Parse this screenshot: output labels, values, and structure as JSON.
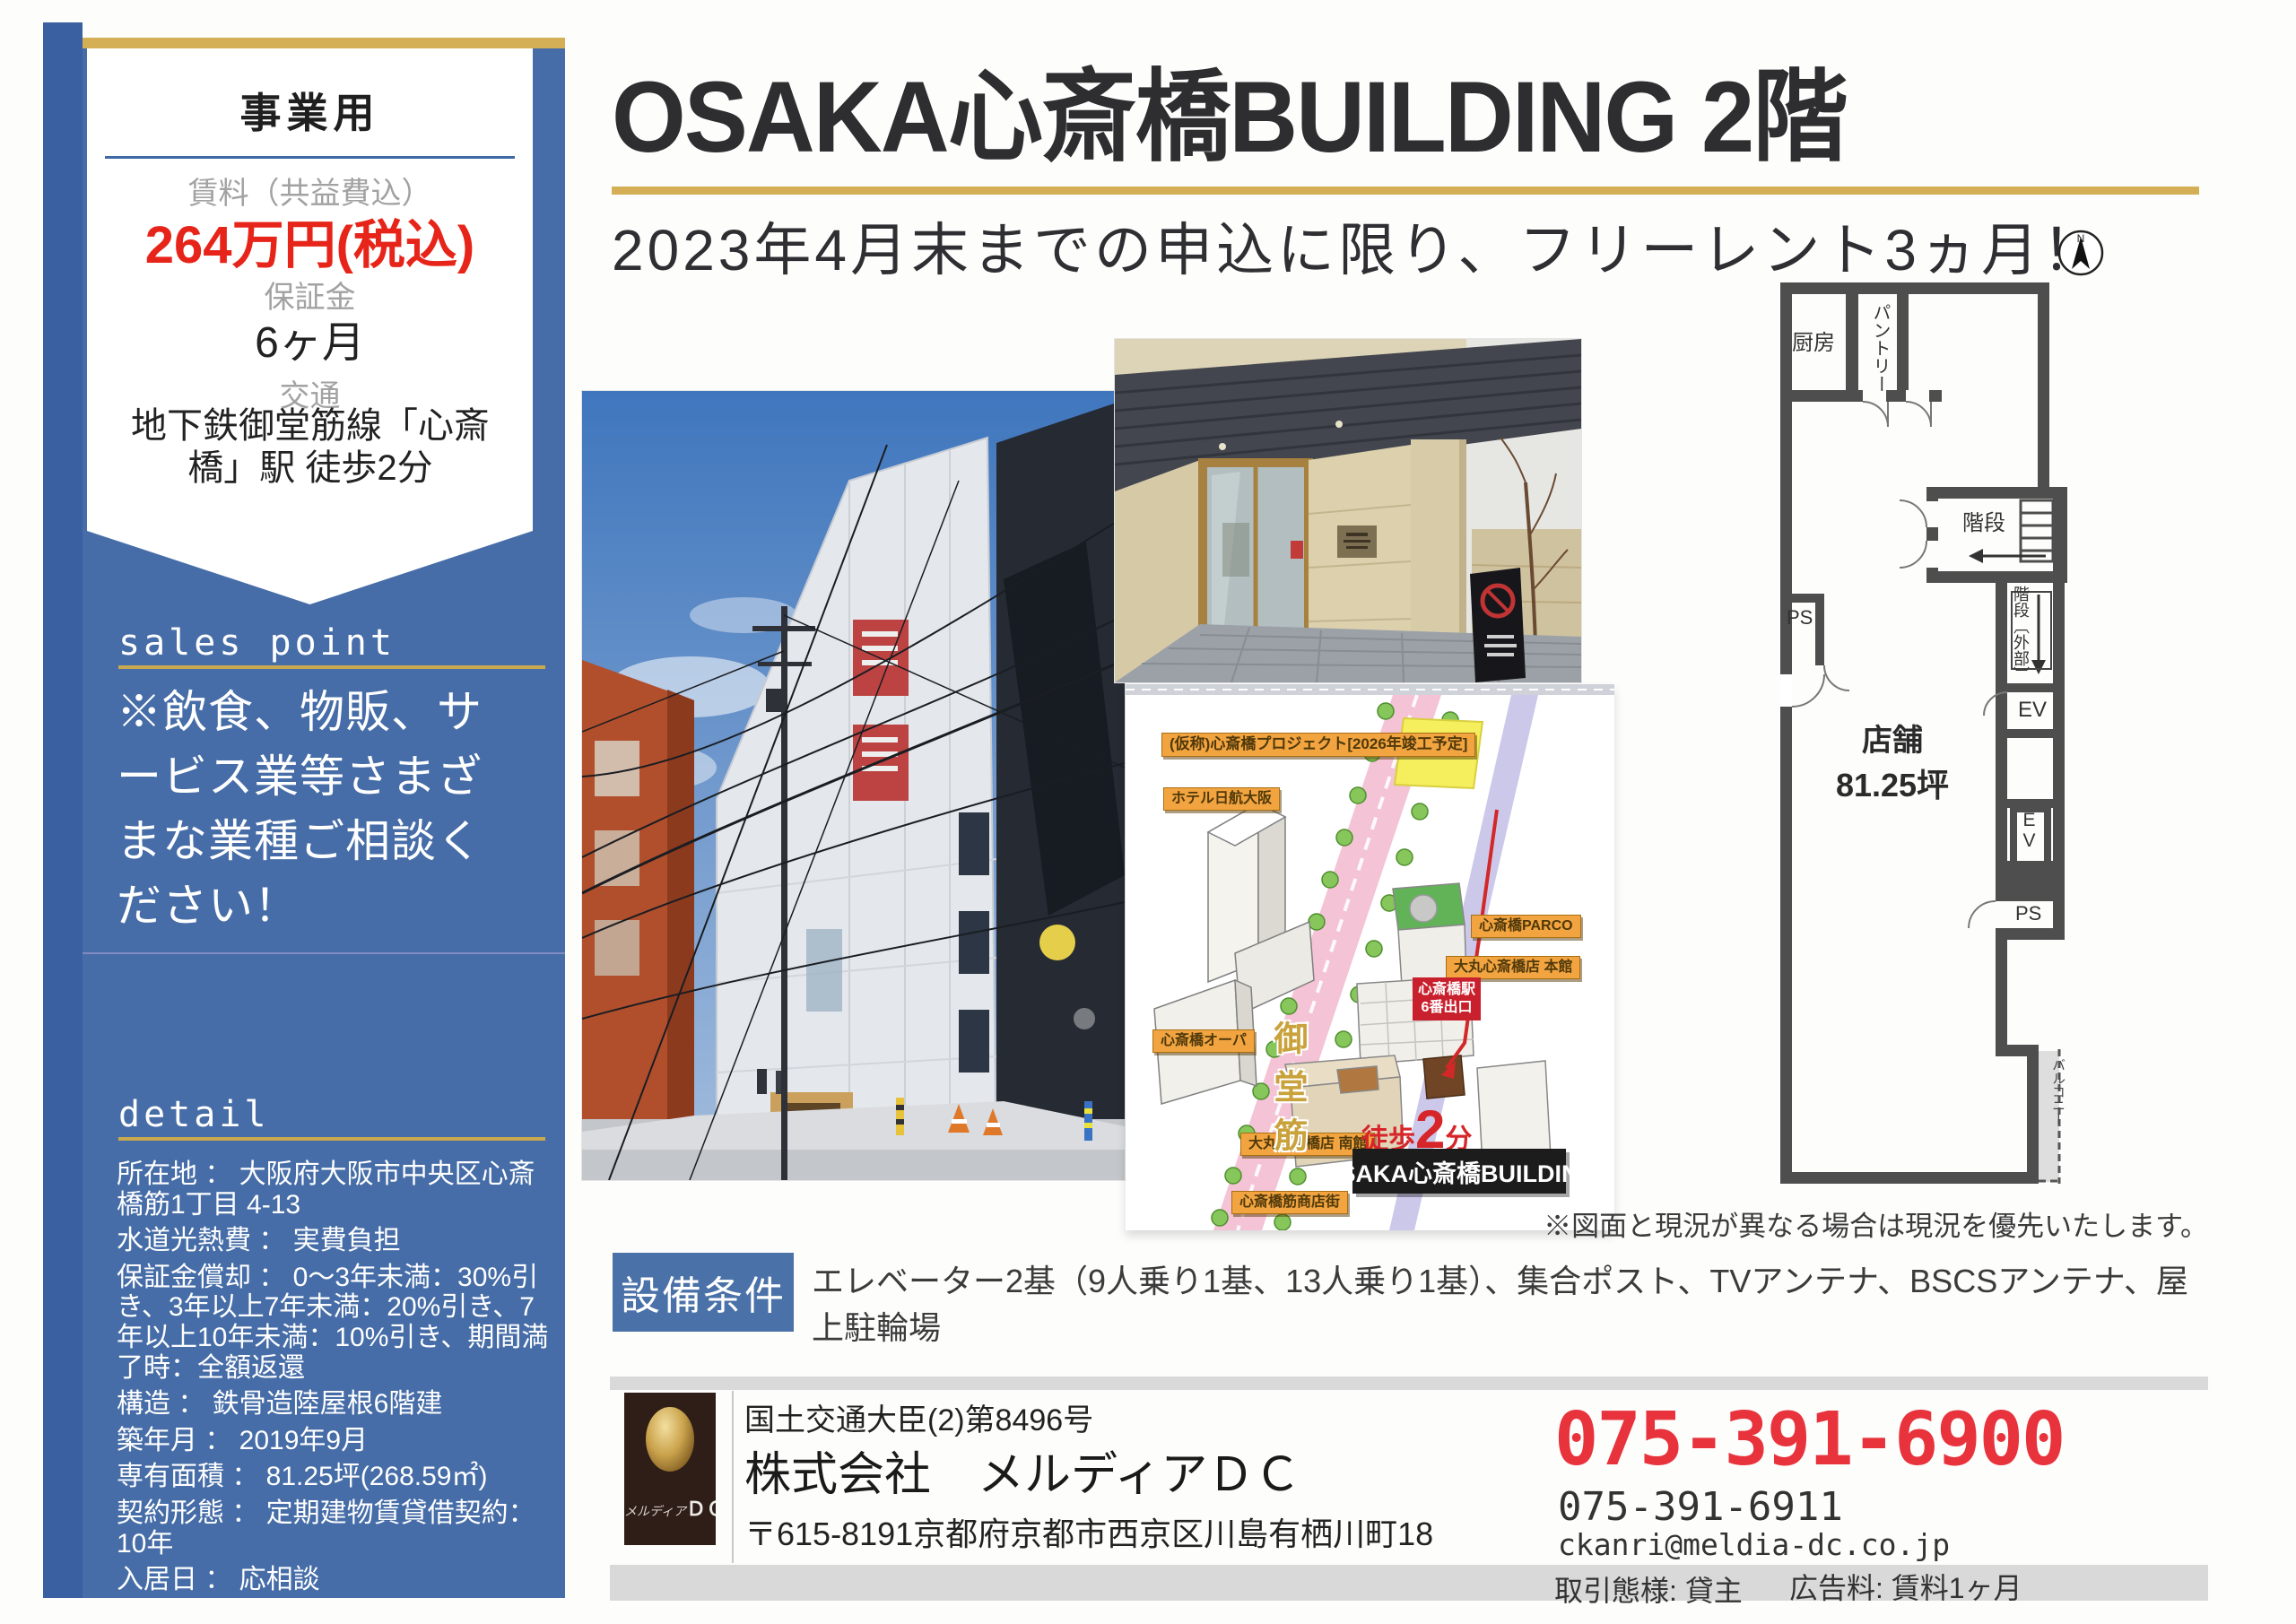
{
  "colors": {
    "accent_gold": "#d4af56",
    "sidebar_blue": "#466da7",
    "price_red": "#e72419",
    "phone_red": "#e8323c",
    "equipment_blue": "#4a72a8",
    "wall_gray": "#4e4e4e"
  },
  "sidebar": {
    "category": "事業用",
    "rent_label": "賃料（共益費込）",
    "rent_value": "264万円(税込)",
    "deposit_label": "保証金",
    "deposit_value": "6ヶ月",
    "access_label": "交通",
    "access_value": "地下鉄御堂筋線「心斎橋」駅 徒歩2分",
    "sales_point": {
      "heading": "sales point",
      "text": "※飲食、物販、サービス業等さまざまな業種ご相談ください！"
    },
    "detail": {
      "heading": "detail",
      "items": [
        "所在地 ： 大阪府大阪市中央区心斎橋筋1丁目 4-13",
        "水道光熱費 ： 実費負担",
        "保証金償却 ： 0～3年未満：30%引き、3年以上7年未満：20%引き、7年以上10年未満：10%引き、期間満了時：全額返還",
        "構造 ： 鉄骨造陸屋根6階建",
        "築年月 ： 2019年9月",
        "専有面積 ： 81.25坪(268.59㎡)",
        "契約形態 ： 定期建物賃貸借契約：10年",
        "入居日 ： 応相談"
      ]
    }
  },
  "header": {
    "title": "OSAKA心斎橋BUILDING 2階",
    "subtitle": "2023年4月末までの申込に限り、フリーレント3ヵ月！",
    "compass_label": "N"
  },
  "floorplan": {
    "labels": {
      "kitchen": "厨房",
      "pantry": "パントリー",
      "stairs": "階段",
      "stairs_ext": "階段〔外部〕",
      "ps_left": "PS",
      "ev1": "EV",
      "ev2": "EV",
      "ps_right": "PS",
      "shop_name": "店舗",
      "shop_area": "81.25坪",
      "balcony": "バルコニー"
    },
    "note": "※図面と現況が異なる場合は現況を優先いたします。"
  },
  "map": {
    "street": "御堂筋",
    "labels": [
      "(仮称)心斎橋プロジェクト[2026年竣工予定]",
      "ホテル日航大阪",
      "心斎橋PARCO",
      "大丸心斎橋店 本館",
      "心斎橋オーパ",
      "大丸心斎橋店 南館",
      "心斎橋筋商店街"
    ],
    "station_line1": "心斎橋駅",
    "station_line2": "6番出口",
    "walk_prefix": "徒歩",
    "walk_num": "2",
    "walk_suffix": "分",
    "walk_distance": "(150m)",
    "building_tag": "OSAKA心斎橋BUILDING"
  },
  "equipment": {
    "label": "設備条件",
    "text": "エレベーター2基（9人乗り1基、13人乗り1基）、集合ポスト、TVアンテナ、BSCSアンテナ、屋上駐輪場"
  },
  "footer": {
    "license": "国土交通大臣(2)第8496号",
    "company": "株式会社　メルディアＤＣ",
    "address": "〒615-8191京都府京都市西京区川島有栖川町18",
    "phone_main": "075-391-6900",
    "phone_sub": "075-391-6911",
    "email": "ckanri@meldia-dc.co.jp",
    "deal_type": "取引態様: 貸主",
    "ad_fee": "広告料: 賃料1ヶ月",
    "logo_text_1": "メルディア",
    "logo_text_2": "ＤＣ"
  }
}
